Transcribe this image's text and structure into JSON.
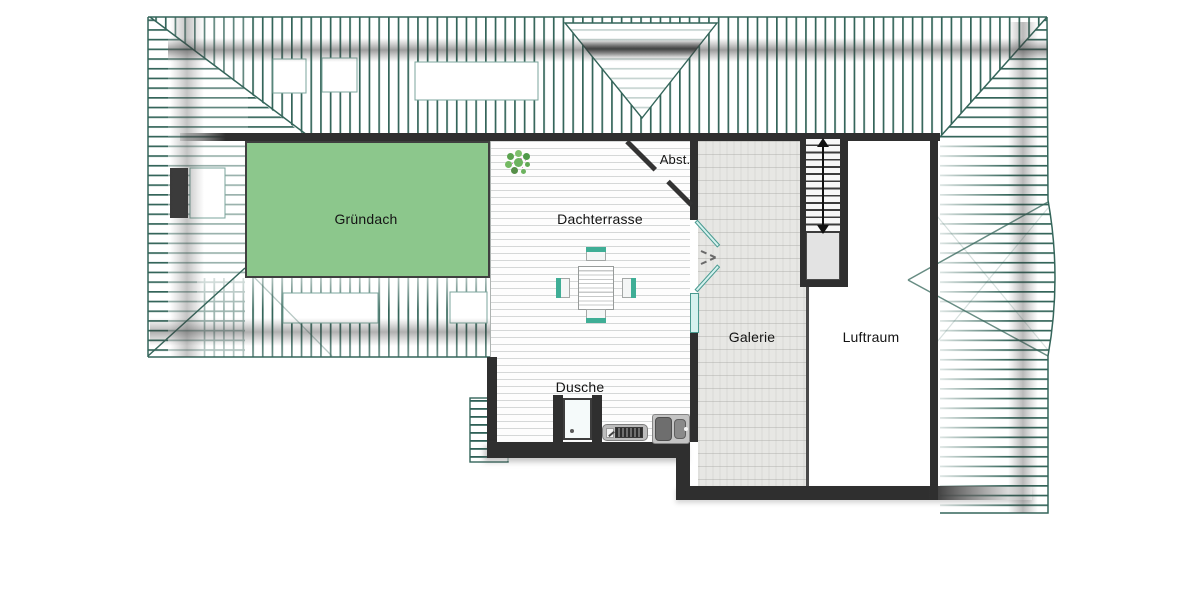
{
  "plan": {
    "type": "floor-plan",
    "floor_labels": {
      "gruendach": "Gründach",
      "dachterrasse": "Dachterrasse",
      "abstellraum": "Abst.",
      "galerie": "Galerie",
      "luftraum": "Luftraum",
      "dusche": "Dusche"
    },
    "colors": {
      "green_roof": "#8cc78c",
      "roof_hatch": "#34655a",
      "wall": "#2f2f2f",
      "furniture_accent": "#3fae96",
      "door_glass": "#d6f2ef",
      "stair_landing": "#e3e3e3"
    },
    "symbols": {
      "stair_direction": "double-headed-arrow",
      "door_type": "double-french-door",
      "fixtures": [
        "shower-tray",
        "radiator",
        "double-sink",
        "dining-table",
        "four-chairs",
        "plant"
      ]
    }
  }
}
